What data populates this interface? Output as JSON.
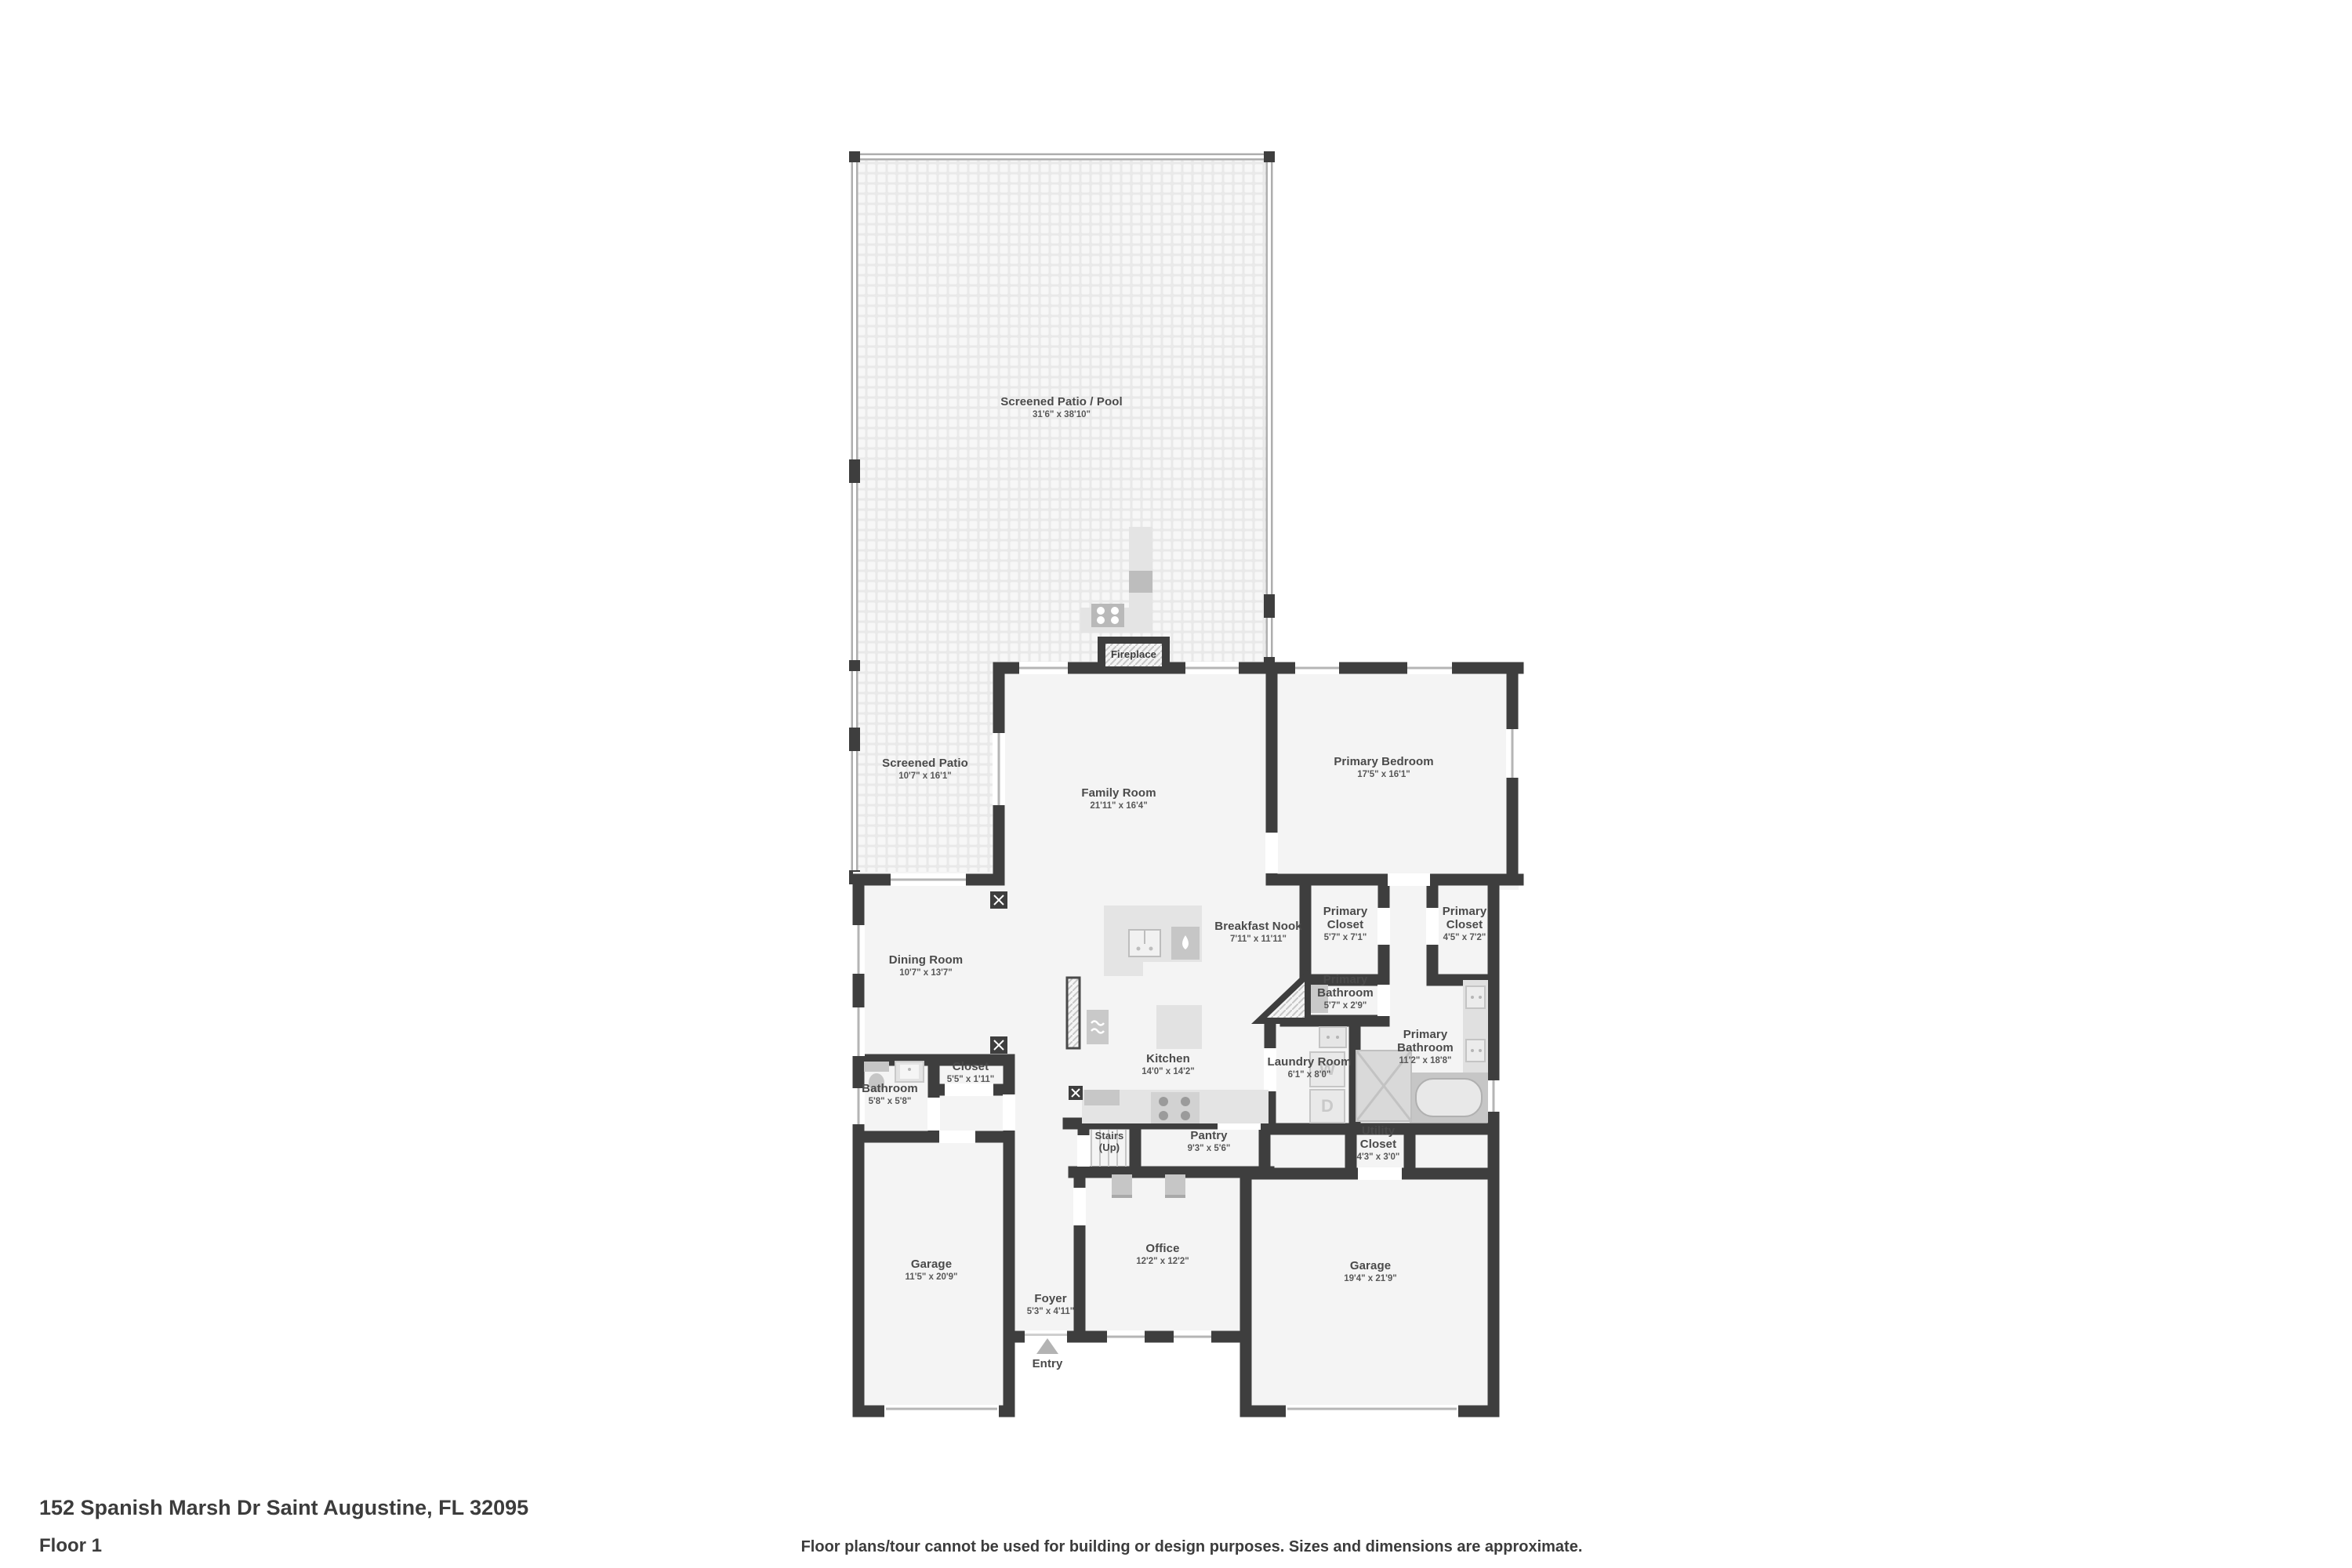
{
  "footer": {
    "address": "152 Spanish Marsh Dr Saint Augustine, FL 32095",
    "floor": "Floor 1",
    "disclaimer": "Floor plans/tour cannot be used for building or design purposes. Sizes and dimensions are approximate."
  },
  "colors": {
    "wall": "#3e3e3e",
    "floor": "#f4f4f4",
    "label_text": "#4a4a4a"
  },
  "rooms": [
    {
      "id": "screened-patio-pool",
      "name": "Screened Patio / Pool",
      "dims": "31'6\" x 38'10\""
    },
    {
      "id": "screened-patio",
      "name": "Screened Patio",
      "dims": "10'7\" x 16'1\""
    },
    {
      "id": "family-room",
      "name": "Family Room",
      "dims": "21'11\" x 16'4\""
    },
    {
      "id": "primary-bedroom",
      "name": "Primary Bedroom",
      "dims": "17'5\" x 16'1\""
    },
    {
      "id": "breakfast-nook",
      "name": "Breakfast Nook",
      "dims": "7'11\" x 11'11\""
    },
    {
      "id": "primary-closet-left",
      "name": "Primary Closet",
      "dims": "5'7\" x 7'1\""
    },
    {
      "id": "primary-closet-right",
      "name": "Primary Closet",
      "dims": "4'5\" x 7'2\""
    },
    {
      "id": "dining-room",
      "name": "Dining Room",
      "dims": "10'7\" x 13'7\""
    },
    {
      "id": "primary-bathroom-wc",
      "name": "Primary Bathroom",
      "dims": "5'7\" x 2'9\""
    },
    {
      "id": "primary-bathroom",
      "name": "Primary Bathroom",
      "dims": "11'2\" x 18'8\""
    },
    {
      "id": "kitchen",
      "name": "Kitchen",
      "dims": "14'0\" x 14'2\""
    },
    {
      "id": "laundry-room",
      "name": "Laundry Room",
      "dims": "6'1\" x 8'0\""
    },
    {
      "id": "closet",
      "name": "Closet",
      "dims": "5'5\" x 1'11\""
    },
    {
      "id": "bathroom",
      "name": "Bathroom",
      "dims": "5'8\" x 5'8\""
    },
    {
      "id": "pantry",
      "name": "Pantry",
      "dims": "9'3\" x 5'6\""
    },
    {
      "id": "utility-closet",
      "name": "Utility Closet",
      "dims": "4'3\" x 3'0\""
    },
    {
      "id": "garage-left",
      "name": "Garage",
      "dims": "11'5\" x 20'9\""
    },
    {
      "id": "office",
      "name": "Office",
      "dims": "12'2\" x 12'2\""
    },
    {
      "id": "foyer",
      "name": "Foyer",
      "dims": "5'3\" x 4'11\""
    },
    {
      "id": "garage-right",
      "name": "Garage",
      "dims": "19'4\" x 21'9\""
    }
  ],
  "annotations": {
    "fireplace": "Fireplace",
    "stairs_line1": "Stairs",
    "stairs_line2": "(Up)",
    "entry": "Entry",
    "washer": "W",
    "dryer": "D"
  }
}
